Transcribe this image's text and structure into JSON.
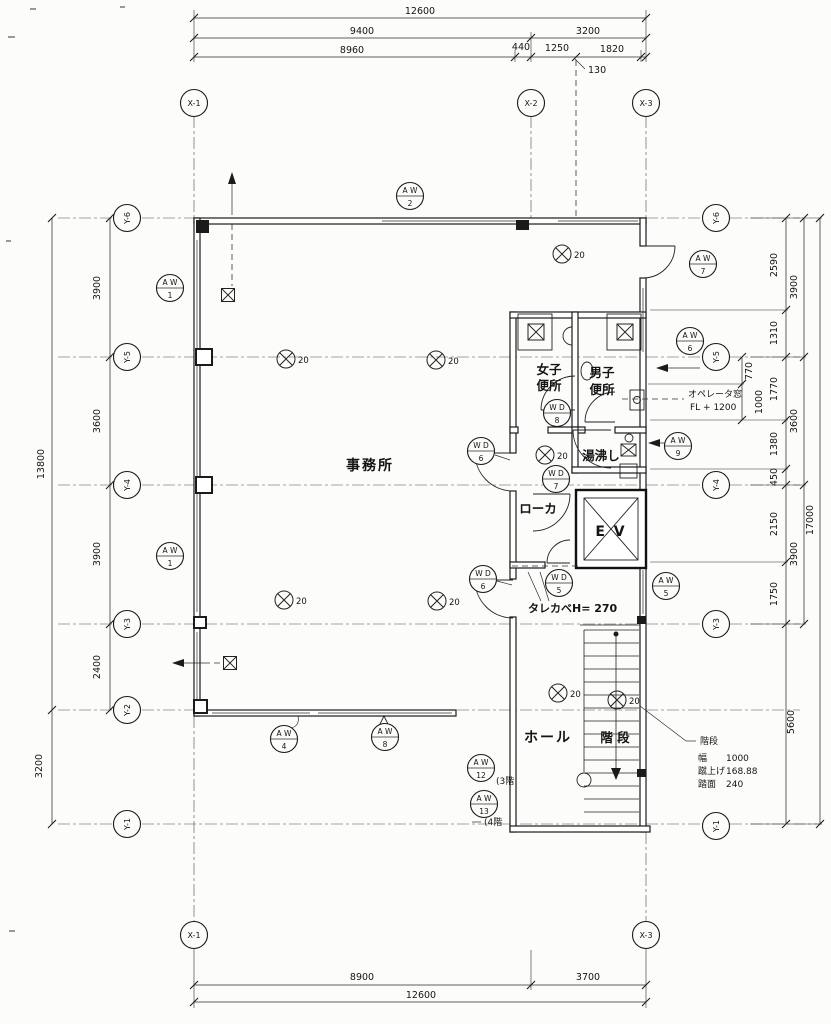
{
  "grid": {
    "x1": "X-1",
    "x2": "X-2",
    "x3": "X-3",
    "y1": "Y-1",
    "y2": "Y-2",
    "y3": "Y-3",
    "y4": "Y-4",
    "y5": "Y-5",
    "y6": "Y-6"
  },
  "dims": {
    "top": {
      "overall": "12600",
      "d9400": "9400",
      "d3200": "3200",
      "d8960": "8960",
      "d440": "440",
      "d1250": "1250",
      "d1820": "1820",
      "d130": "130"
    },
    "bottom": {
      "d8900": "8900",
      "d3700": "3700",
      "overall": "12600"
    },
    "left": {
      "overall": "13800",
      "d3900a": "3900",
      "d3600": "3600",
      "d3900b": "3900",
      "d2400": "2400",
      "d3200": "3200"
    },
    "right": {
      "d2590": "2590",
      "d1310": "1310",
      "d770": "770",
      "d1000": "1000",
      "d1770": "1770",
      "d1380": "1380",
      "d450": "450",
      "d2150": "2150",
      "d1750": "1750",
      "d5600": "5600",
      "o3900a": "3900",
      "o3600": "3600",
      "o3900b": "3900",
      "overall": "17000"
    }
  },
  "rooms": {
    "office": "事務所",
    "women_1": "女子",
    "women_2": "便所",
    "men_1": "男子",
    "men_2": "便所",
    "yuwakashi": "湯沸し",
    "corridor": "ローカ",
    "elevator": "E V",
    "hall": "ホール",
    "stairs": "階 段"
  },
  "notes": {
    "operator_1": "オペレータ窓",
    "operator_2": "FL + 1200",
    "tarekabe": "タレカベH= 270",
    "stair_title": "階段",
    "stair_width_label": "幅",
    "stair_width": "1000",
    "stair_riser_label": "蹴上げ",
    "stair_riser": "168.88",
    "stair_tread_label": "踏面",
    "stair_tread": "240",
    "aw12_note": "(3階",
    "aw13_note": "(4階",
    "light": "20"
  },
  "tags": {
    "aw": "A W",
    "wd": "W D",
    "n1": "1",
    "n2": "2",
    "n4": "4",
    "n5": "5",
    "n6": "6",
    "n7": "7",
    "n8": "8",
    "n9": "9",
    "n12": "12",
    "n13": "13"
  }
}
